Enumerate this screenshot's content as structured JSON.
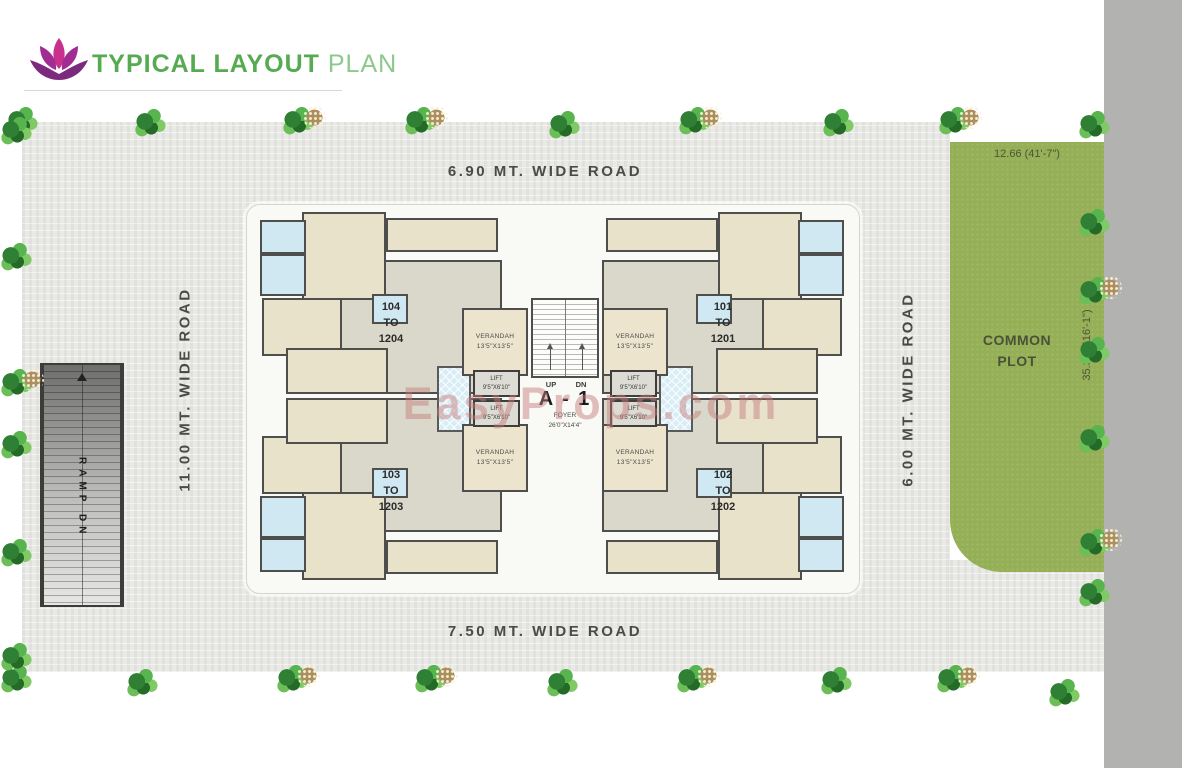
{
  "header": {
    "title_strong": "TYPICAL LAYOUT",
    "title_light": "PLAN"
  },
  "roads": {
    "top": "6.90 MT. WIDE ROAD",
    "bottom": "7.50 MT. WIDE ROAD",
    "left": "11.00 MT. WIDE ROAD",
    "right": "6.00 MT. WIDE ROAD"
  },
  "ramp": {
    "label": "RAMP DN"
  },
  "common_plot": {
    "line1": "COMMON",
    "line2": "PLOT",
    "dim_top": "12.66 (41'-7\")",
    "dim_side": "35.39 (116'-1\")"
  },
  "building": {
    "name": "A - 1",
    "foyer_name": "FOYER",
    "foyer_size": "26'0\"X14'4\"",
    "up": "UP",
    "dn": "DN",
    "verandah_name": "VERANDAH",
    "verandah_size": "13'5\"X13'5\"",
    "lift_name": "LIFT",
    "lift_size": "9'5\"X6'10\"",
    "units": [
      {
        "l1": "104",
        "l2": "TO",
        "l3": "1204"
      },
      {
        "l1": "101",
        "l2": "TO",
        "l3": "1201"
      },
      {
        "l1": "103",
        "l2": "TO",
        "l3": "1203"
      },
      {
        "l1": "102",
        "l2": "TO",
        "l3": "1202"
      }
    ]
  },
  "watermark": "EasyProps.com",
  "colors": {
    "accent_green": "#56ab52",
    "light_green": "#8cc98a",
    "logo_magenta": "#c9318f",
    "logo_purple": "#8e2c88",
    "plot_green": "#94af55",
    "wall": "#4e4e4c",
    "road_text": "#4a4a48"
  },
  "plants": [
    {
      "x": 6,
      "y": 106
    },
    {
      "x": 134,
      "y": 108
    },
    {
      "x": 282,
      "y": 106,
      "cone": true
    },
    {
      "x": 404,
      "y": 106,
      "cone": true
    },
    {
      "x": 548,
      "y": 110
    },
    {
      "x": 678,
      "y": 106,
      "cone": true
    },
    {
      "x": 822,
      "y": 108
    },
    {
      "x": 938,
      "y": 106,
      "cone": true
    },
    {
      "x": 1078,
      "y": 110
    },
    {
      "x": 0,
      "y": 664
    },
    {
      "x": 126,
      "y": 668
    },
    {
      "x": 276,
      "y": 664,
      "cone": true
    },
    {
      "x": 414,
      "y": 664,
      "cone": true
    },
    {
      "x": 546,
      "y": 668
    },
    {
      "x": 676,
      "y": 664,
      "cone": true
    },
    {
      "x": 820,
      "y": 666
    },
    {
      "x": 936,
      "y": 664,
      "cone": true
    },
    {
      "x": 1048,
      "y": 678
    },
    {
      "x": 0,
      "y": 116
    },
    {
      "x": 0,
      "y": 242
    },
    {
      "x": 0,
      "y": 368,
      "cone": true
    },
    {
      "x": 0,
      "y": 430
    },
    {
      "x": 0,
      "y": 538
    },
    {
      "x": 0,
      "y": 642
    },
    {
      "x": 1078,
      "y": 208
    },
    {
      "x": 1078,
      "y": 276,
      "cone": true
    },
    {
      "x": 1078,
      "y": 336
    },
    {
      "x": 1078,
      "y": 424
    },
    {
      "x": 1078,
      "y": 528,
      "cone": true
    },
    {
      "x": 1078,
      "y": 578
    }
  ]
}
